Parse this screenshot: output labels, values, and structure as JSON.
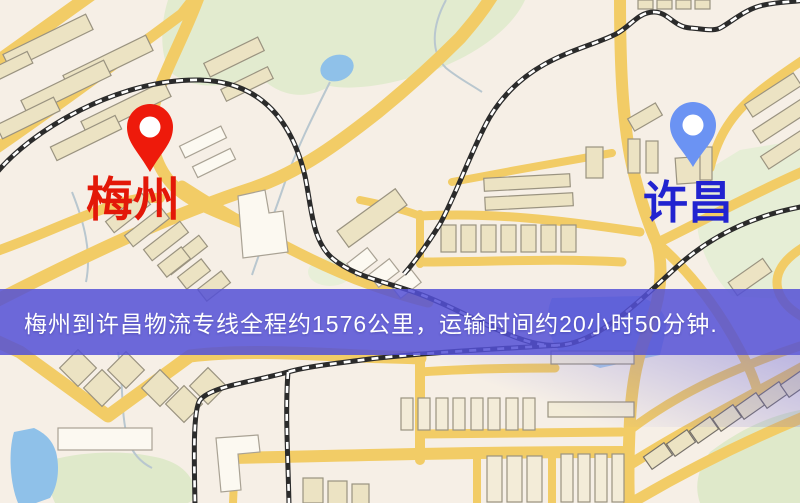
{
  "banner": {
    "text": "梅州到许昌物流专线全程约1576公里，运输时间约20小时50分钟.",
    "origin_city": "梅州",
    "destination_city": "许昌",
    "distance_km": "1576",
    "duration_hours": "20",
    "duration_minutes": "50",
    "background_color": "#5450d6",
    "text_color": "#ffffff"
  },
  "markers": {
    "origin": {
      "label": "梅州",
      "icon": "map-pin",
      "pin_color": "#ee1a0b",
      "label_color": "#e31808"
    },
    "destination": {
      "label": "许昌",
      "icon": "map-pin",
      "pin_color": "#6b93f3",
      "label_color": "#2123d0"
    }
  },
  "map": {
    "style": "street-map",
    "road_color": "#f2cc66",
    "park_color": "#e2ebcf",
    "water_color": "#8fc1e9",
    "building_color": "#ece3c3",
    "railway_color": "#2b2b2b",
    "background_color": "#f6efe6"
  }
}
